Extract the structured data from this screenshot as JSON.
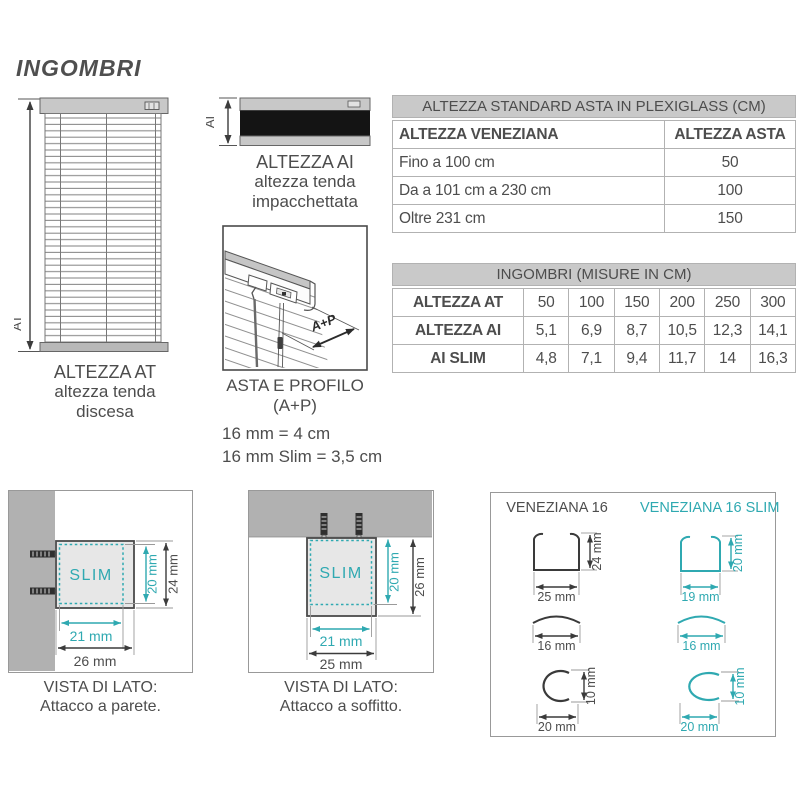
{
  "page": {
    "title": "INGOMBRI"
  },
  "colors": {
    "accent_teal": "#2fa9b1",
    "text_gray": "#4d4d4d"
  },
  "diagrams": {
    "blind_down": {
      "axis_label": "AT",
      "caption_title": "ALTEZZA AT",
      "caption_line1": "altezza tenda",
      "caption_line2": "discesa"
    },
    "blind_packed": {
      "axis_label": "AI",
      "caption_title": "ALTEZZA AI",
      "caption_line1": "altezza tenda",
      "caption_line2": "impacchettata"
    },
    "asta_profilo": {
      "arrow_label": "A+P",
      "caption_title": "ASTA E PROFILO",
      "caption_sub": "(A+P)",
      "note1": "16 mm = 4 cm",
      "note2": "16 mm Slim = 3,5 cm"
    }
  },
  "tables": {
    "plexiglass": {
      "title": "ALTEZZA STANDARD ASTA IN PLEXIGLASS (CM)",
      "col1_header": "ALTEZZA VENEZIANA",
      "col2_header": "ALTEZZA ASTA",
      "rows": [
        {
          "label": "Fino a 100 cm",
          "value": "50"
        },
        {
          "label": "Da a 101 cm a 230 cm",
          "value": "100"
        },
        {
          "label": "Oltre 231 cm",
          "value": "150"
        }
      ]
    },
    "ingombri": {
      "title": "INGOMBRI (MISURE IN CM)",
      "rows": [
        {
          "label": "ALTEZZA AT",
          "values": [
            "50",
            "100",
            "150",
            "200",
            "250",
            "300"
          ]
        },
        {
          "label": "ALTEZZA AI",
          "values": [
            "5,1",
            "6,9",
            "8,7",
            "10,5",
            "12,3",
            "14,1"
          ]
        },
        {
          "label": "AI SLIM",
          "values": [
            "4,8",
            "7,1",
            "9,4",
            "11,7",
            "14",
            "16,3"
          ]
        }
      ]
    }
  },
  "panels": {
    "wall": {
      "slim_label": "SLIM",
      "dim_inner_h": "20 mm",
      "dim_outer_h": "24 mm",
      "dim_inner_w": "21 mm",
      "dim_outer_w": "26 mm",
      "caption_line1": "VISTA DI LATO:",
      "caption_line2": "Attacco a parete."
    },
    "ceiling": {
      "slim_label": "SLIM",
      "dim_inner_h": "20 mm",
      "dim_outer_h": "26 mm",
      "dim_inner_w": "21 mm",
      "dim_outer_w": "25 mm",
      "caption_line1": "VISTA DI LATO:",
      "caption_line2": "Attacco a soffitto."
    },
    "profiles": {
      "left_title": "VENEZIANA 16",
      "right_title": "VENEZIANA 16 SLIM",
      "left": {
        "channel_w": "25 mm",
        "channel_h": "24 mm",
        "slat_w": "16 mm",
        "rail_w": "20 mm",
        "rail_h": "10 mm"
      },
      "right": {
        "channel_w": "19 mm",
        "channel_h": "20 mm",
        "slat_w": "16 mm",
        "rail_w": "20 mm",
        "rail_h": "10 mm"
      }
    }
  }
}
